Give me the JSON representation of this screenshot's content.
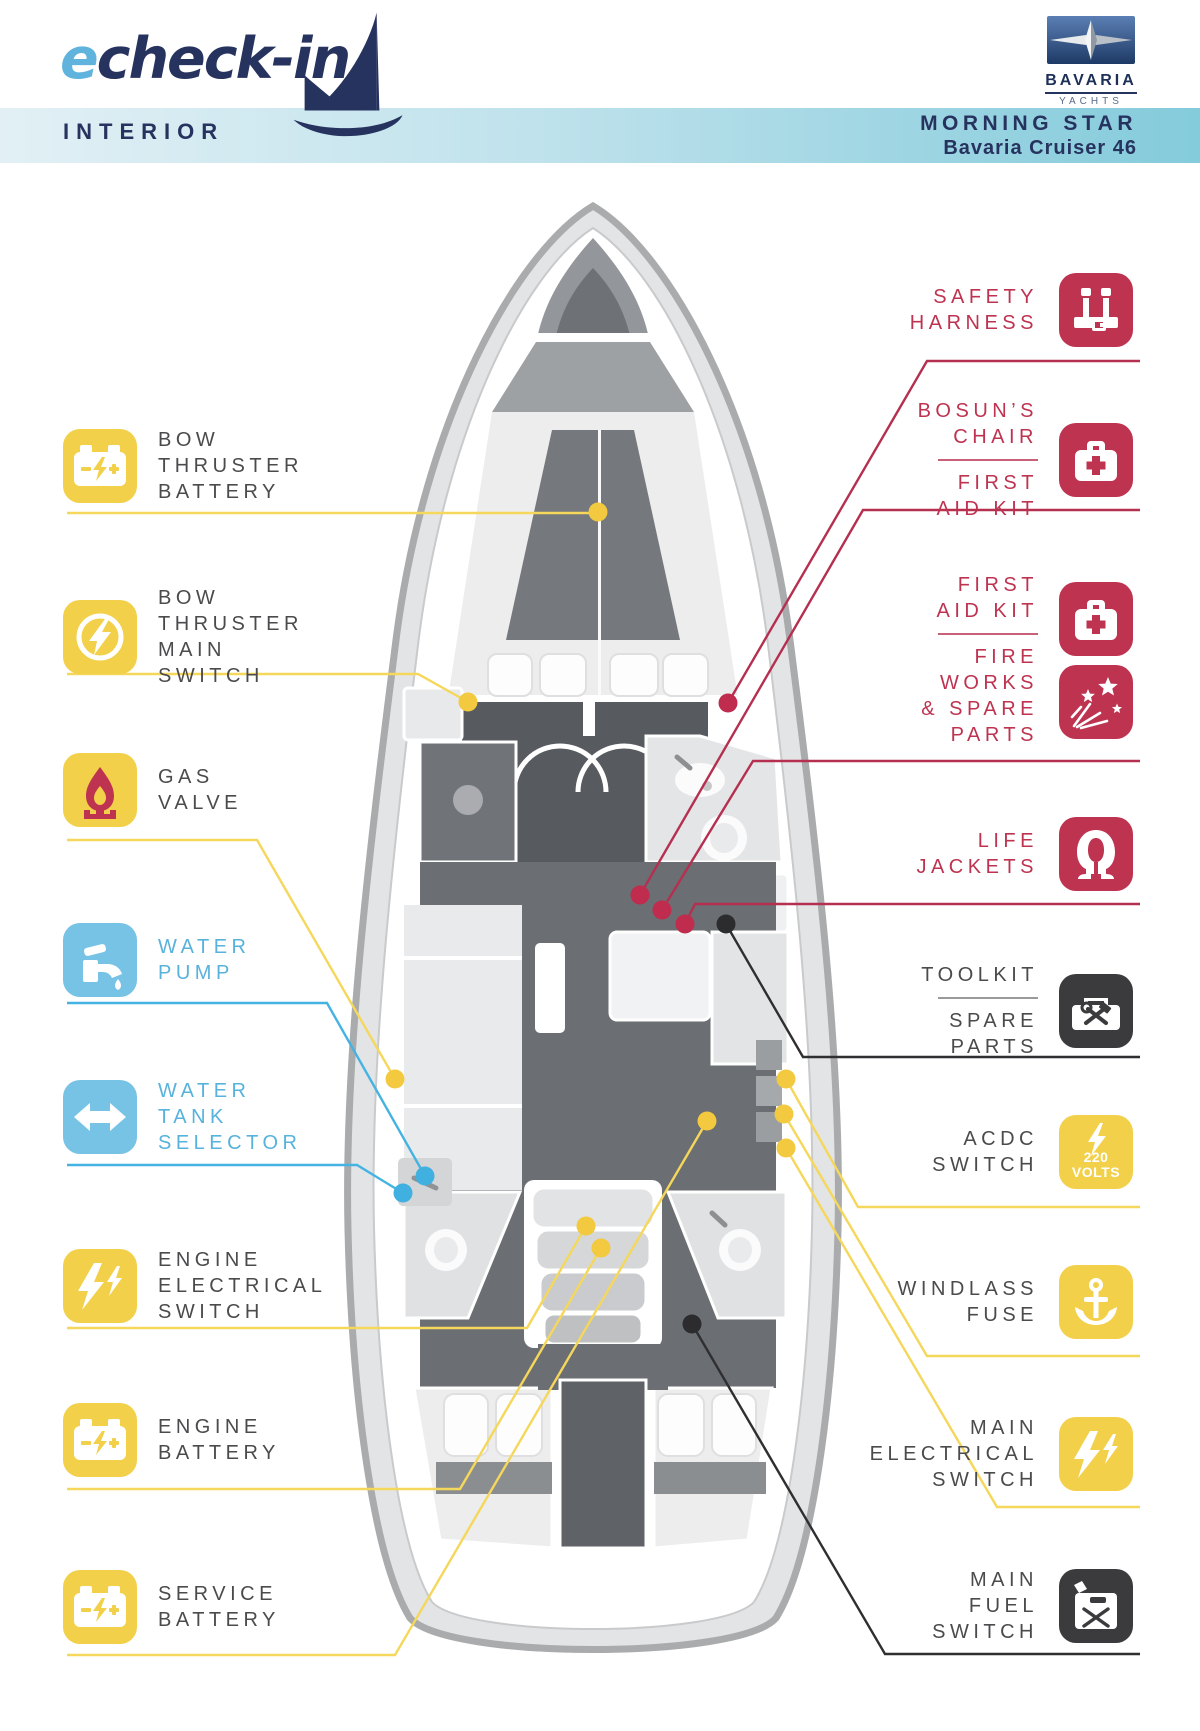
{
  "header": {
    "brand_e": "e",
    "brand_rest": "check-in",
    "section": "INTERIOR",
    "logo_name": "BAVARIA",
    "logo_sub": "YACHTS",
    "boat_name": "MORNING STAR",
    "boat_model": "Bavaria Cruiser 46"
  },
  "colors": {
    "navy": "#27335f",
    "accent_yellow": "#f2d049",
    "accent_blue": "#77c3e5",
    "accent_red": "#be3350",
    "accent_dark": "#3b3b3d",
    "band_gradient": [
      "#e2f0f5",
      "#84cbdb"
    ],
    "label_text": "#4b4b4d",
    "label_text_blue": "#57b2dc"
  },
  "labels_left": [
    {
      "icon": "battery-icon",
      "text": "BOW\nTHRUSTER\nBATTERY"
    },
    {
      "icon": "lightning-circle-icon",
      "text": "BOW\nTHRUSTER\nMAIN\nSWITCH"
    },
    {
      "icon": "gas-flame-icon",
      "text": "GAS\nVALVE"
    },
    {
      "icon": "faucet-icon",
      "text": "WATER\nPUMP"
    },
    {
      "icon": "double-arrow-icon",
      "text": "WATER\nTANK\nSELECTOR"
    },
    {
      "icon": "double-lightning-icon",
      "text": "ENGINE\nELECTRICAL\nSWITCH"
    },
    {
      "icon": "battery-icon",
      "text": "ENGINE\nBATTERY"
    },
    {
      "icon": "battery-icon",
      "text": "SERVICE\nBATTERY"
    }
  ],
  "labels_right": [
    {
      "icon": "safety-harness-icon",
      "text": "SAFETY\nHARNESS"
    },
    {
      "icon": "first-aid-icon",
      "text_top": "BOSUN’S\nCHAIR",
      "text_bottom": "FIRST\nAID KIT"
    },
    {
      "icon_top": "first-aid-icon",
      "icon_bottom": "fireworks-icon",
      "text_top": "FIRST\nAID KIT",
      "text_bottom": "FIRE\nWORKS\n& SPARE\nPARTS"
    },
    {
      "icon": "life-jacket-icon",
      "text": "LIFE\nJACKETS"
    },
    {
      "icon": "toolkit-icon",
      "text_top": "TOOLKIT",
      "text_bottom": "SPARE\nPARTS"
    },
    {
      "icon": "acdc-icon",
      "text": "ACDC\nSWITCH",
      "icon_text": "220\nVOLTS"
    },
    {
      "icon": "windlass-anchor-icon",
      "text": "WINDLASS\nFUSE"
    },
    {
      "icon": "double-lightning-icon",
      "text": "MAIN\nELECTRICAL\nSWITCH"
    },
    {
      "icon": "fuel-can-icon",
      "text": "MAIN\nFUEL\nSWITCH"
    }
  ]
}
